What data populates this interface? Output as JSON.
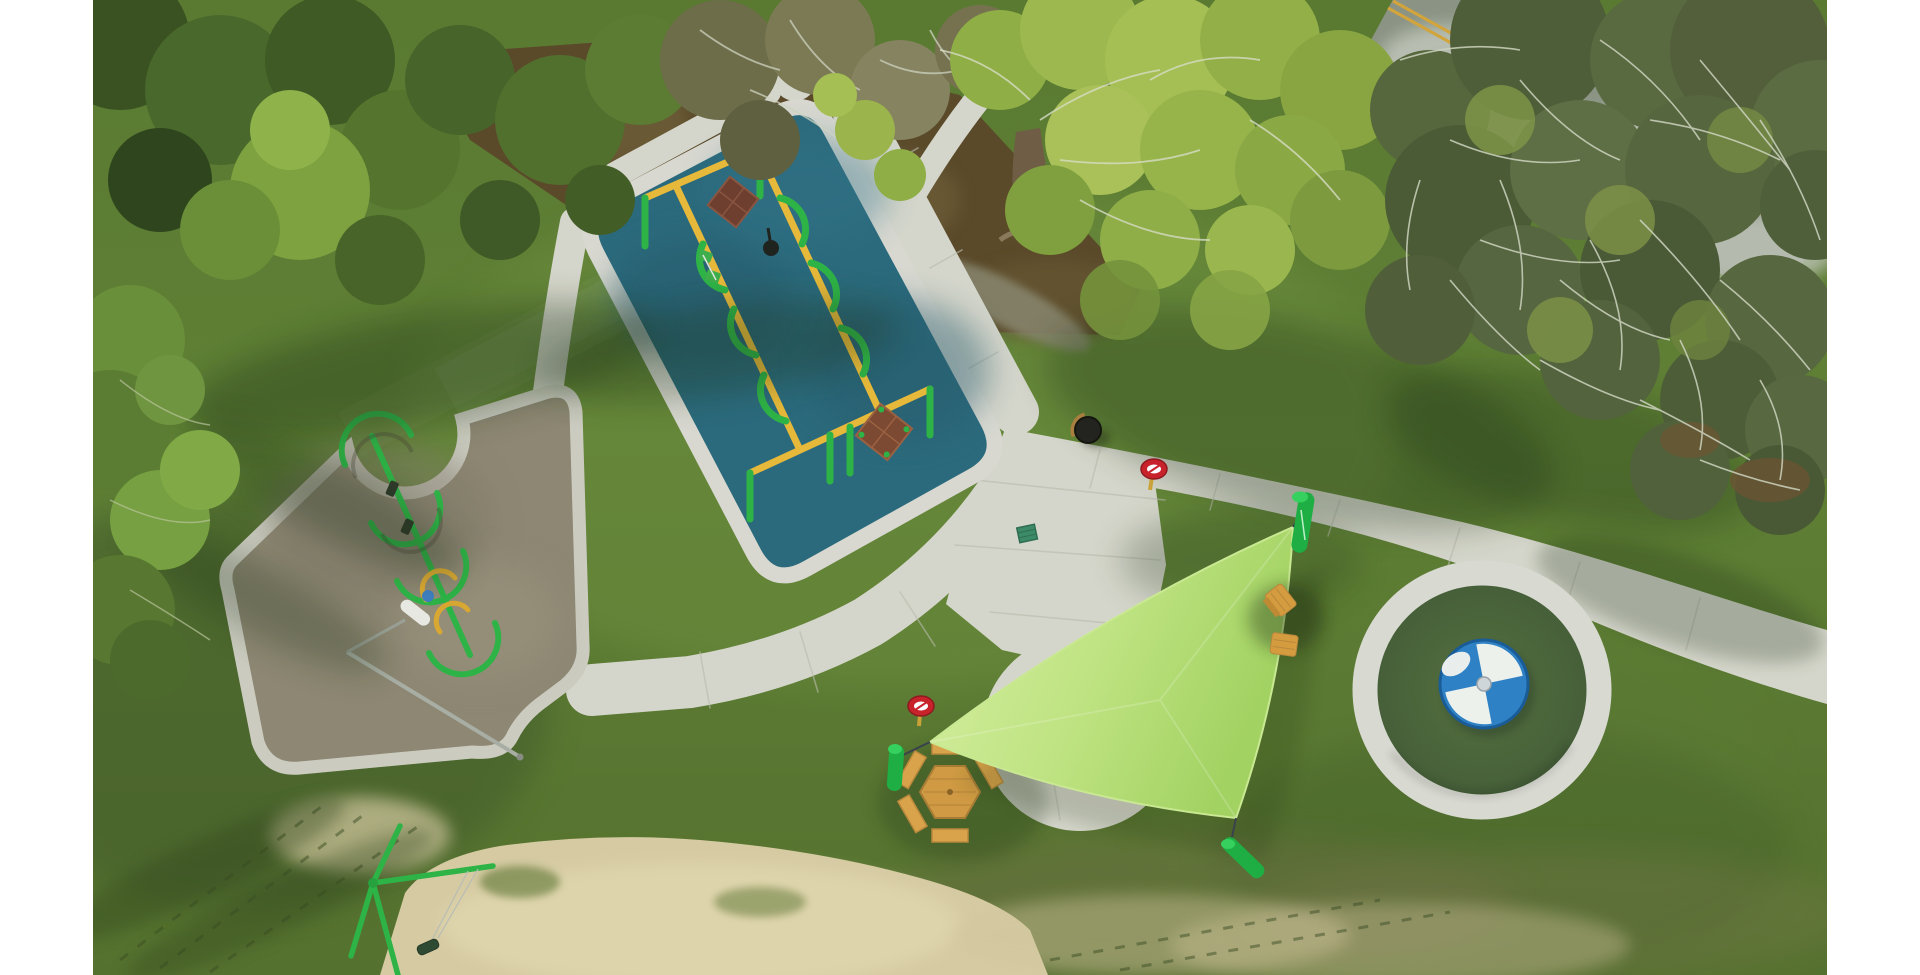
{
  "scene": {
    "title": "Aerial drone photo of a park playground",
    "description": "Top-down aerial photograph of a park playground: a teal rubber swing pad with yellow-and-green swing frames and two square wood tables, a tan rubber play pad with a green zip-line rail and a light pole, winding concrete walking paths meeting at a concrete circle shaded by a lime-green triangular shade sail on green posts, a dark-green circular pad with a blue-and-white quadrant spinner, a hexagonal picnic table, two wooden lawn chairs, a trash can, two small red oval signs, a green drain grate, mowed lawns with tree shadows, dense forest and leaf litter at top left, large trees over a road with a double yellow centerline at top right, and a sandy area with a green swing frame at bottom left.",
    "matte": "white side bars",
    "photo_bounds": {
      "left_px": 93,
      "right_px": 1827,
      "top_px": 0,
      "bottom_px": 975
    }
  },
  "palette": {
    "matte": "#ffffff",
    "grass_light": "#6e9040",
    "grass_mid": "#5c7c33",
    "grass_dark": "#42592a",
    "concrete": "#d5d6cb",
    "concrete_joint": "#b9bbae",
    "mat_teal": "#2b6a7c",
    "mat_border": "#d8d8d0",
    "pad_tan": "#8d8773",
    "ring_white": "#d8d9d1",
    "pad_green": "#4d6b3d",
    "spinner_blue": "#2e81c4",
    "spinner_white": "#edf1ec",
    "sail_light": "#d7f0a4",
    "sail_dark": "#a2d262",
    "equip_green": "#2eb347",
    "beam_yellow": "#e7b93a",
    "table_dark_wood": "#6e3e2f",
    "table_mid_wood": "#7c4932",
    "picnic_tan": "#d8a34a",
    "sand": "#d5caa2",
    "forest_floor": "#5a4a2a",
    "road_gray": "#8b9484",
    "road_line_yellow": "#d2a43c",
    "sign_red": "#c8232b",
    "canopy_dark": "#3a5222",
    "canopy_bright": "#7da23f",
    "canopy_yellowgreen": "#a6bf55",
    "canopy_olive": "#56663e",
    "branch_white": "#cdd3bf",
    "trunk_brown": "#6f5e45"
  },
  "elements": [
    {
      "name": "swing-mat",
      "label": "teal rubber swing pad with concrete border"
    },
    {
      "name": "swing-frames",
      "label": "yellow beam swing frames with green arch legs"
    },
    {
      "name": "square-wood-tables",
      "label": "two square wood play tables on mat"
    },
    {
      "name": "tan-playpad",
      "label": "tan rubber pad with green zip-line rail"
    },
    {
      "name": "light-pole",
      "label": "park light pole with white luminaire"
    },
    {
      "name": "path-network",
      "label": "concrete walking paths and plaza circle"
    },
    {
      "name": "shade-sail",
      "label": "lime triangular shade sail on three green posts"
    },
    {
      "name": "spinner-pad",
      "label": "green circular pad with blue and white spinner"
    },
    {
      "name": "hex-picnic-table",
      "label": "hexagonal picnic table with benches"
    },
    {
      "name": "lawn-chairs",
      "label": "two wooden lawn chairs"
    },
    {
      "name": "trash-can",
      "label": "round trash can"
    },
    {
      "name": "park-signs",
      "label": "two small red oval signs"
    },
    {
      "name": "drain-grate",
      "label": "green drain grate"
    },
    {
      "name": "sand-area",
      "label": "sand area with green swing frame"
    },
    {
      "name": "road",
      "label": "road with double yellow centerline under trees"
    },
    {
      "name": "forest",
      "label": "forest canopy and leaf litter"
    }
  ]
}
